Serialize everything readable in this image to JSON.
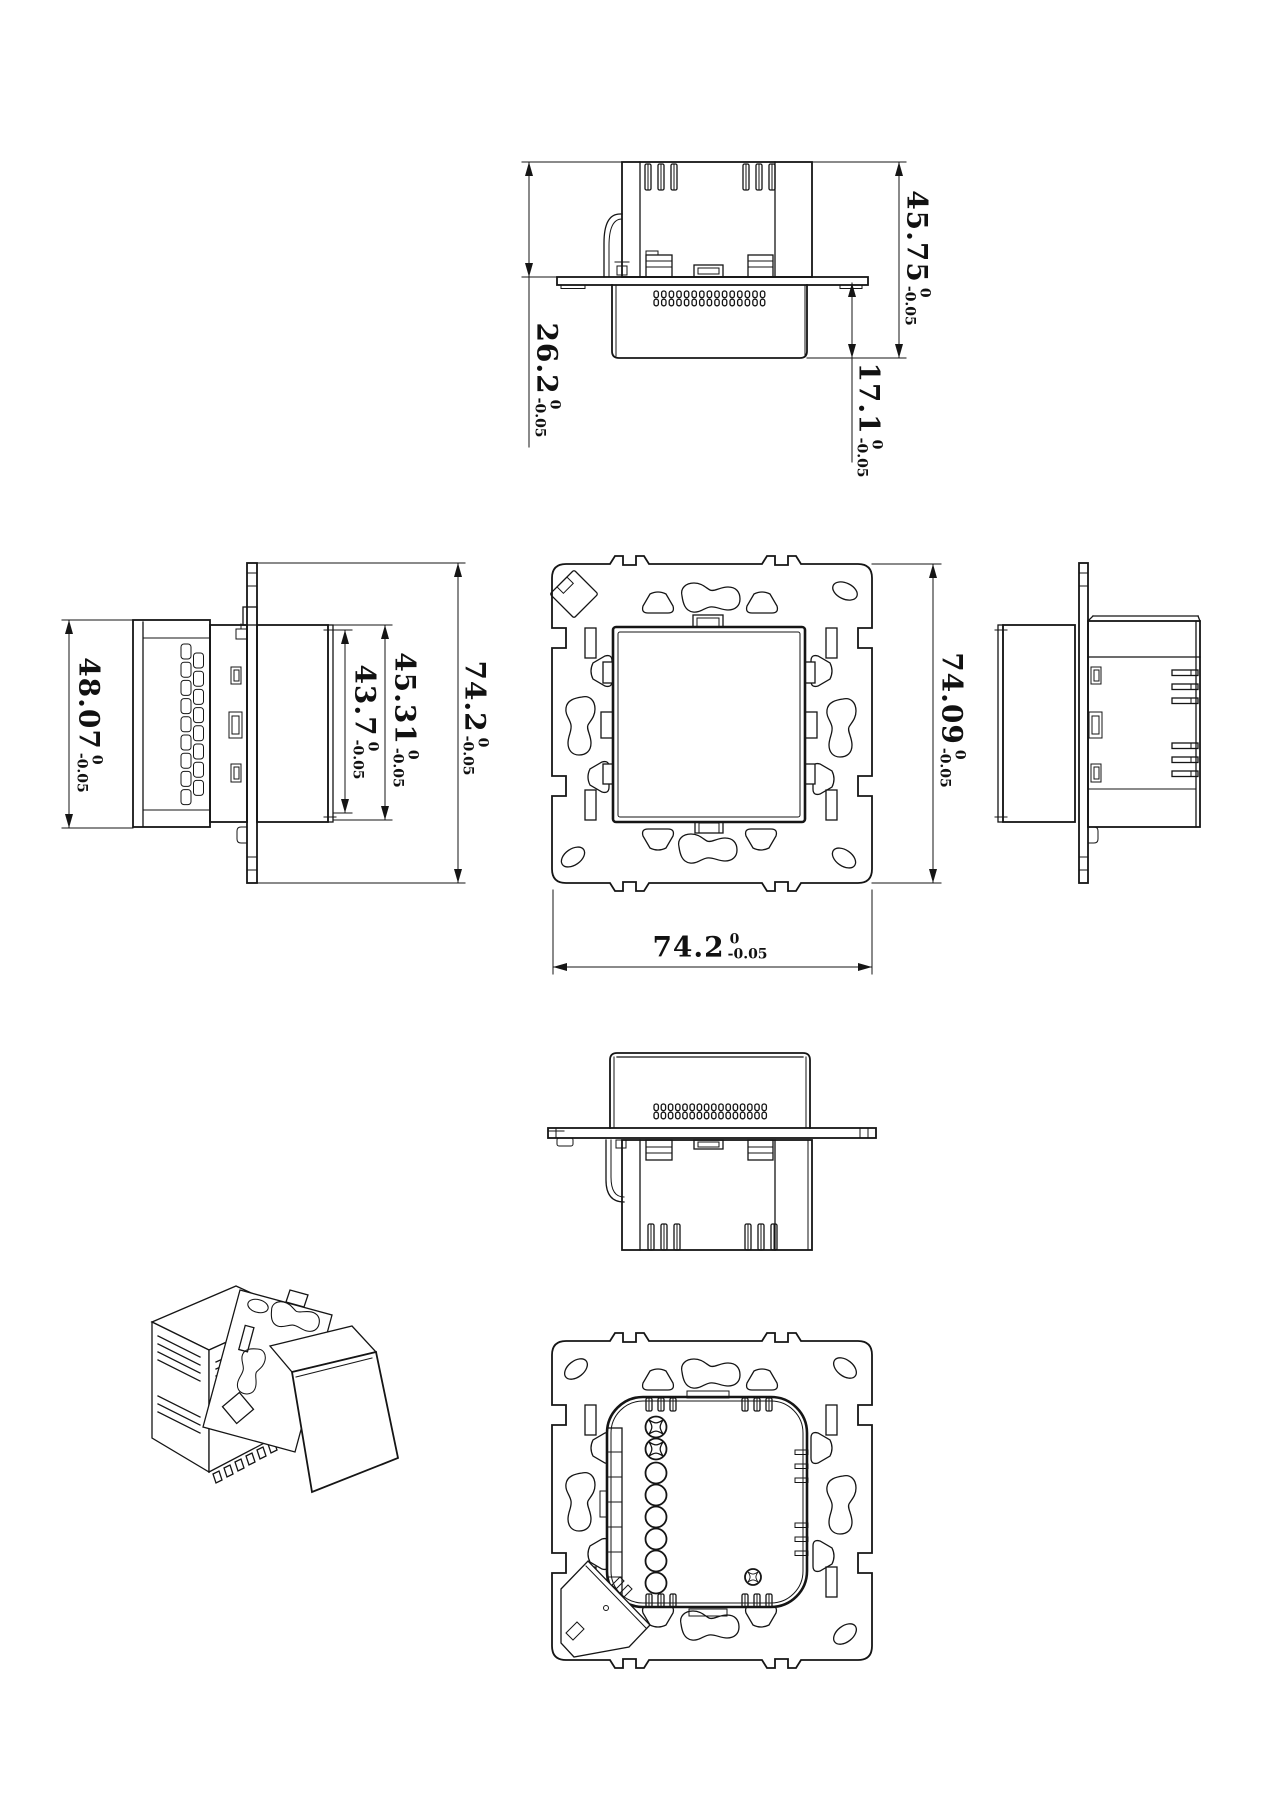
{
  "colors": {
    "line": "#151515",
    "background": "#ffffff"
  },
  "dimensions": {
    "top_view": {
      "overall_height": {
        "value": "45.75",
        "tol_upper": "0",
        "tol_lower": "-0.05"
      },
      "body_height": {
        "value": "26.2",
        "tol_upper": "0",
        "tol_lower": "-0.05"
      },
      "cover_depth": {
        "value": "17.1",
        "tol_upper": "0",
        "tol_lower": "-0.05"
      }
    },
    "left_view": {
      "module_height": {
        "value": "48.07",
        "tol_upper": "0",
        "tol_lower": "-0.05"
      },
      "face_height": {
        "value": "43.7",
        "tol_upper": "0",
        "tol_lower": "-0.05"
      },
      "cover_height": {
        "value": "45.31",
        "tol_upper": "0",
        "tol_lower": "-0.05"
      },
      "frame_height": {
        "value": "74.2",
        "tol_upper": "0",
        "tol_lower": "-0.05"
      }
    },
    "front_view": {
      "frame_height": {
        "value": "74.09",
        "tol_upper": "0",
        "tol_lower": "-0.05"
      },
      "frame_width": {
        "value": "74.2",
        "tol_upper": "0",
        "tol_lower": "-0.05"
      }
    }
  }
}
